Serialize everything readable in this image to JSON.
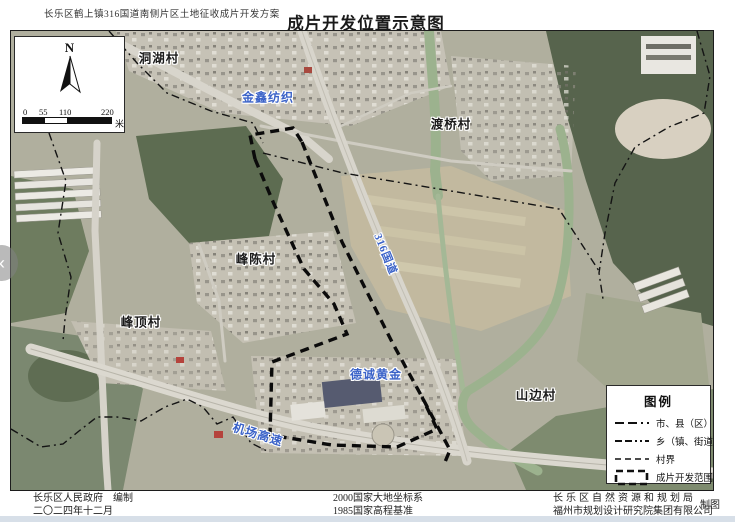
{
  "header": {
    "plan_title": "长乐区鹤上镇316国道南侧片区土地征收成片开发方案",
    "map_title": "成片开发位置示意图"
  },
  "inset": {
    "north_label": "N",
    "scale_ticks": [
      "0",
      "55",
      "110",
      "220"
    ],
    "scale_unit": "米"
  },
  "map_labels": {
    "donghu_village": "洞湖村",
    "jinxin_textile": "金鑫纺织",
    "duqiao_village": "渡桥村",
    "road_316": "316国道",
    "fengchen_village": "峰陈村",
    "fengding_village": "峰顶村",
    "decheng_gold": "德诚黄金",
    "shanbian_village": "山边村",
    "airport_expressway": "机场高速"
  },
  "legend": {
    "title": "图例",
    "items": [
      {
        "label": "市、县（区）界",
        "symbol": "dash-dash-dot-line"
      },
      {
        "label": "乡（镇、街道）界",
        "symbol": "dash-dash-dot-dot-line"
      },
      {
        "label": "村界",
        "symbol": "short-dashed-line"
      },
      {
        "label": "成片开发范围",
        "symbol": "bold-dashed-rectangle"
      }
    ]
  },
  "footer": {
    "compiler": "长乐区人民政府　编制",
    "date": "二〇二四年十二月",
    "datum": "2000国家大地坐标系",
    "height_datum": "1985国家高程基准",
    "bureau": "长乐区自然资源和规划局",
    "institute": "福州市规划设计研究院集团有限公司",
    "cartography": "制图"
  },
  "nav": {
    "prev_label": "‹"
  },
  "colors": {
    "label_blue": "#3a62c8",
    "boundary_black": "#111111",
    "page_background": "#d7dfe8"
  }
}
